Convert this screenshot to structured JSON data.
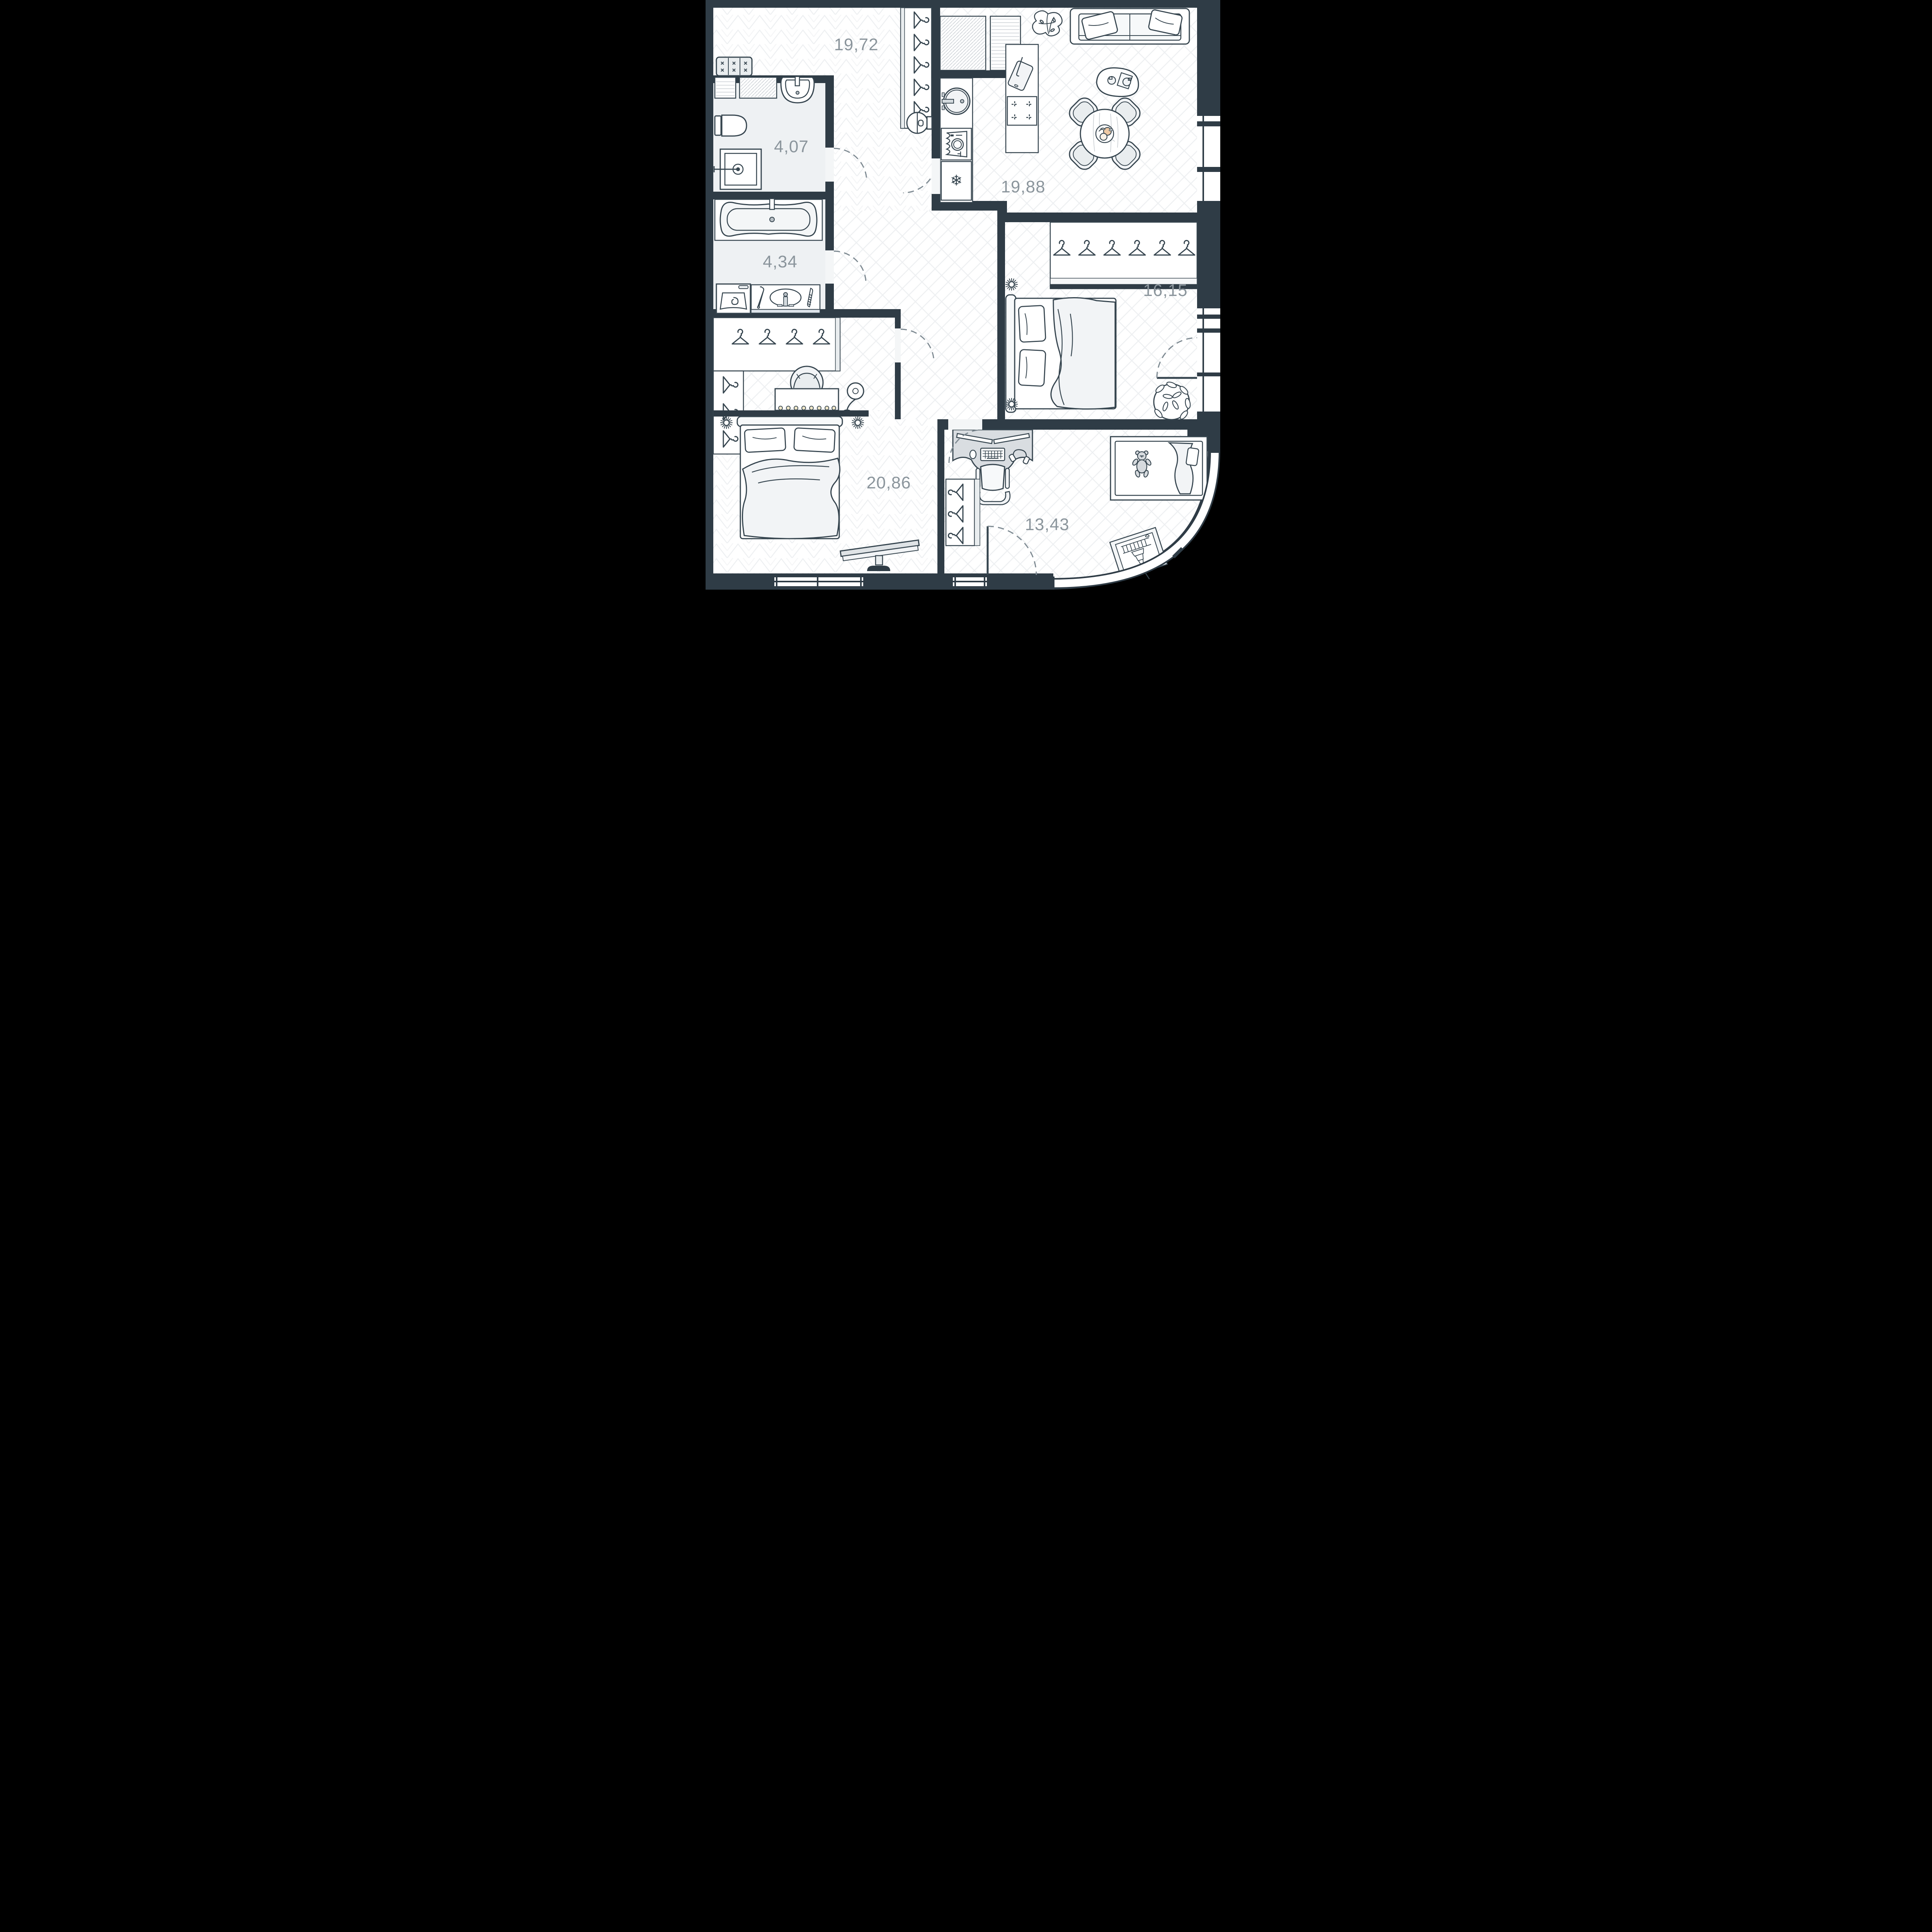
{
  "title": "Apartment floor plan",
  "colors": {
    "wall": "#2f3c46",
    "outside": "#000000",
    "floor": "#ffffff",
    "bathroom_floor": "#eef1f3",
    "pattern_line": "#eef0f2",
    "furniture_line": "#36454f",
    "light_fill": "#e9edef",
    "desk_fill": "#d9dde1",
    "label_text": "#8b959c",
    "accent_fruit_peach": "#eec9a4",
    "accent_bulb_cream": "#efe6c8",
    "vanity_strip_blue": "#dde4ea"
  },
  "icons": {
    "snowflake": "❄"
  },
  "rooms": [
    {
      "id": "hallway",
      "area": "19,72"
    },
    {
      "id": "bathroom",
      "area": "4,07"
    },
    {
      "id": "bathroom-2",
      "area": "4,34"
    },
    {
      "id": "kitchen-living",
      "area": "19,88"
    },
    {
      "id": "bedroom",
      "area": "16,15"
    },
    {
      "id": "bedroom-2",
      "area": "20,86"
    },
    {
      "id": "children-room",
      "area": "13,43"
    }
  ],
  "furniture": {
    "hallway": [
      "tufted-bench",
      "hanger-closet-5",
      "robot-vacuum"
    ],
    "bathroom": [
      "vent-duct-horizontal",
      "vent-duct-diagonal",
      "wall-sink",
      "toilet",
      "shower-tray"
    ],
    "bathroom-2": [
      "bathtub",
      "washing-machine",
      "vanity-counter",
      "hair-straightener",
      "oval-sink",
      "comb"
    ],
    "kitchen-living": [
      "vent-duct-diagonal",
      "vent-duct-horizontal",
      "kitchen-sink",
      "dishwasher",
      "fridge",
      "island-cutting-board",
      "island-hob",
      "monstera-plant",
      "sofa",
      "sofa-pillows",
      "coffee-table",
      "dining-table",
      "dining-chairs-4",
      "fruit-plate"
    ],
    "bedroom": [
      "hanger-closet-6",
      "double-bed",
      "pillows-2",
      "blanket",
      "wall-sconce-2",
      "leafy-plant",
      "balcony-door"
    ],
    "bedroom-2": [
      "hanger-closet-4",
      "hanger-closet-3",
      "armchair",
      "vanity-table-with-bulbs",
      "floor-lamp",
      "double-bed",
      "pillows-2",
      "blanket",
      "wall-sconce-2",
      "tv-on-stand",
      "window"
    ],
    "children-room": [
      "gaming-desk",
      "monitors-2",
      "keyboard",
      "mouse",
      "headphones",
      "office-chair",
      "crib",
      "teddy-bear",
      "hanger-closet-3",
      "easel-artwork",
      "balcony-door",
      "bay-window"
    ]
  }
}
